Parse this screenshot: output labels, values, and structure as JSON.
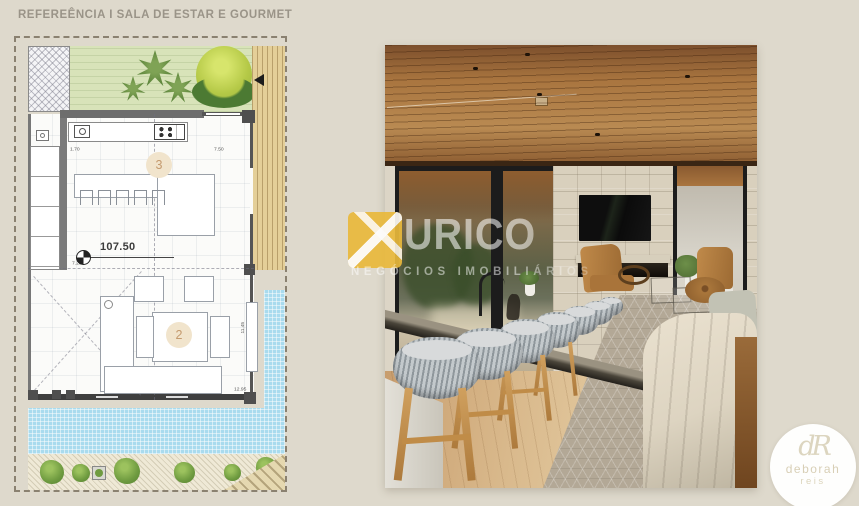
{
  "slide": {
    "title": "REFEREÊNCIA I SALA DE ESTAR E GOURMET"
  },
  "floor_plan": {
    "level_label": "107.50",
    "kitchen_number": "3",
    "living_number": "2",
    "dims": {
      "counter_left": "1.70",
      "counter_right": "7.50",
      "kitchen_bottom": "7.20",
      "living_right": "11.45",
      "living_corner": "12.95"
    }
  },
  "watermark": {
    "brand": "URICO",
    "tagline": "NEGÓCIOS IMOBILIÁRIOS"
  },
  "agency_badge": {
    "monogram": "dR",
    "name": "deborah",
    "surname": "reis"
  },
  "colors": {
    "c-bg": "#DED9CC",
    "c-title": "#9A9488",
    "c-plan-border": "#8A8170",
    "c-grass": "#D8E3B9",
    "c-deck": "#E4CF98",
    "c-pool": "#A9DBEE",
    "c-bush": "#6F9B40",
    "c-stone": "#D9D0BD",
    "c-ceiling": "#B98A52",
    "c-floor": "#D9B98C",
    "c-stool": "#B9BFC2",
    "c-sofa": "#DDD4C1",
    "c-gold": "#E9B93C"
  }
}
